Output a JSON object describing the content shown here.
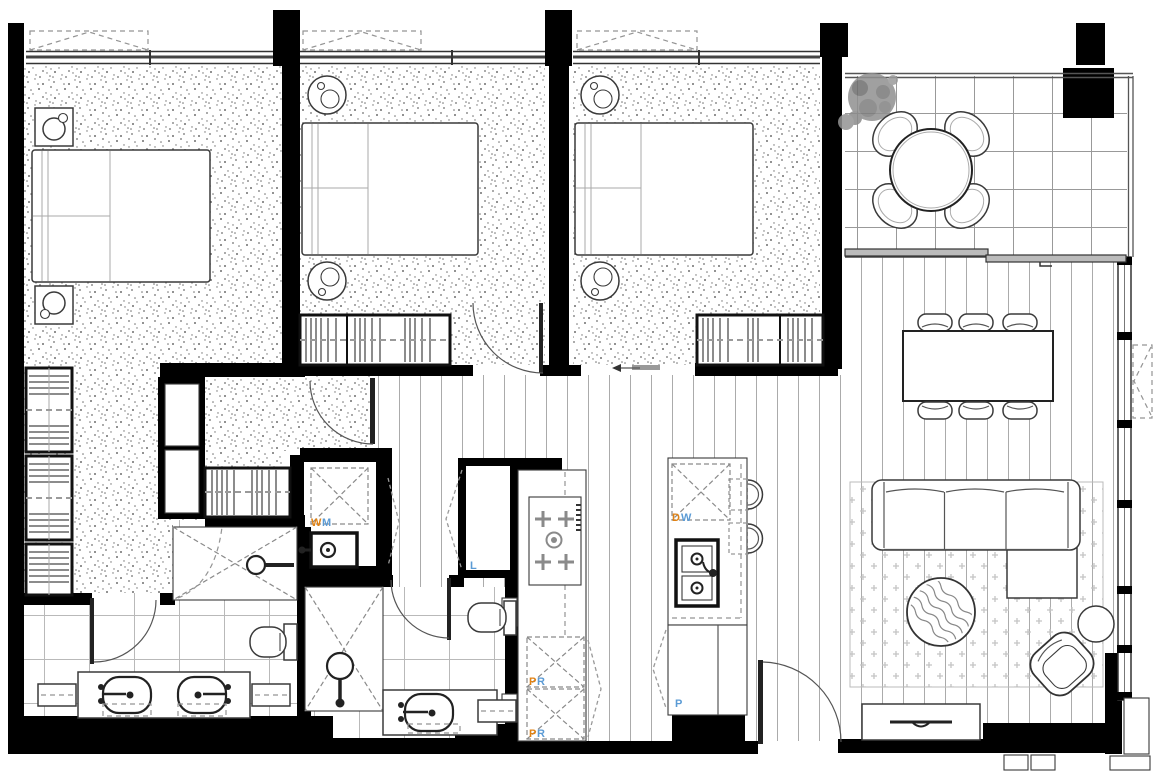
{
  "floorplan": {
    "appliance_labels": {
      "washing_machine": {
        "c1": "W",
        "c2": "M"
      },
      "dishwasher": {
        "c1": "D",
        "c2": "W"
      },
      "pantry_upper": {
        "c1": "P",
        "c2": "R"
      },
      "pantry_lower": {
        "c1": "P",
        "c2": "R"
      },
      "tall_pantry": {
        "c1": "P"
      },
      "linen": {
        "c1": "L"
      }
    },
    "colors": {
      "walls": "#000000",
      "label_orange": "#e08214",
      "label_blue": "#5b9bd5",
      "fixture_outline": "#333333",
      "floor_lines": "#ababab"
    }
  }
}
